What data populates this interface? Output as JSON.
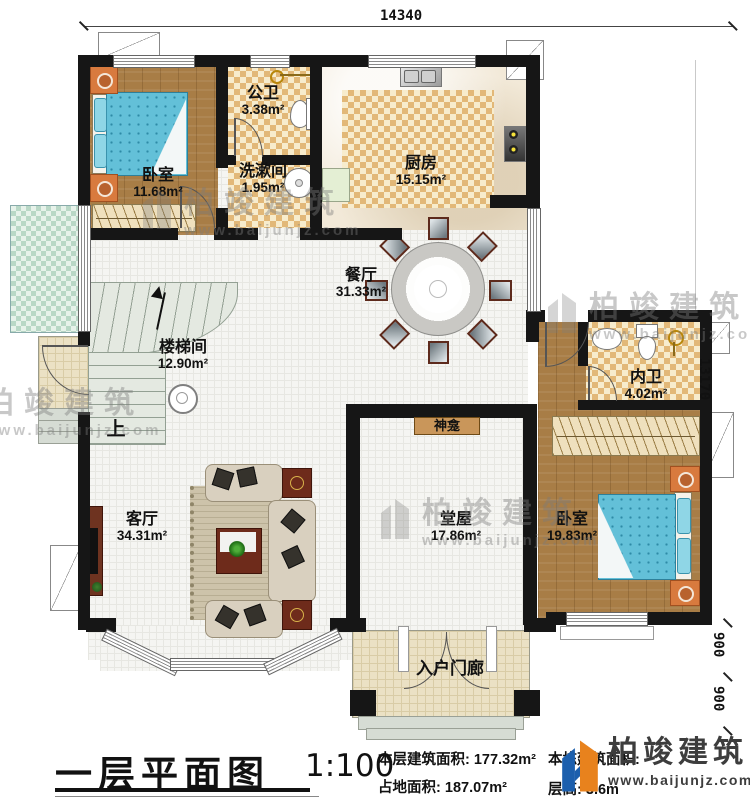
{
  "plan": {
    "title": "一层平面图",
    "scale": "1:100",
    "stats": {
      "floor_area_label": "本层建筑面积:",
      "floor_area_value": "177.32m²",
      "land_area_label": "占地面积:",
      "land_area_value": "187.07m²",
      "total_area_label": "本栋建筑面积:",
      "height_label": "层高:",
      "height_value": "3.6m"
    },
    "dimensions": {
      "top": "14340",
      "right": "13170",
      "lower": [
        "900",
        "900"
      ]
    },
    "rooms": {
      "bedroom_tl": {
        "name": "卧室",
        "area": "11.68m²"
      },
      "public_bath": {
        "name": "公卫",
        "area": "3.38m²"
      },
      "washroom": {
        "name": "洗漱间",
        "area": "1.95m²"
      },
      "kitchen": {
        "name": "厨房",
        "area": "15.15m²"
      },
      "dining": {
        "name": "餐厅",
        "area": "31.33m²"
      },
      "stairwell": {
        "name": "楼梯间",
        "area": "12.90m²"
      },
      "ensuite_bath": {
        "name": "内卫",
        "area": "4.02m²"
      },
      "hall": {
        "name": "堂屋",
        "area": "17.86m²"
      },
      "living": {
        "name": "客厅",
        "area": "34.31m²"
      },
      "bedroom_r": {
        "name": "卧室",
        "area": "19.83m²"
      },
      "porch": {
        "name": "入户门廊"
      }
    },
    "annotations": {
      "shrine": "神龛",
      "up": "上"
    },
    "watermark": {
      "brand": "柏竣建筑",
      "url": "www.baijunjz.com"
    },
    "colors": {
      "wall": "#161616",
      "checker_tan": "#e2b878",
      "bed_blue": "#63c0d8",
      "brand_blue": "#1c5fad",
      "brand_orange": "#e8821d"
    }
  }
}
